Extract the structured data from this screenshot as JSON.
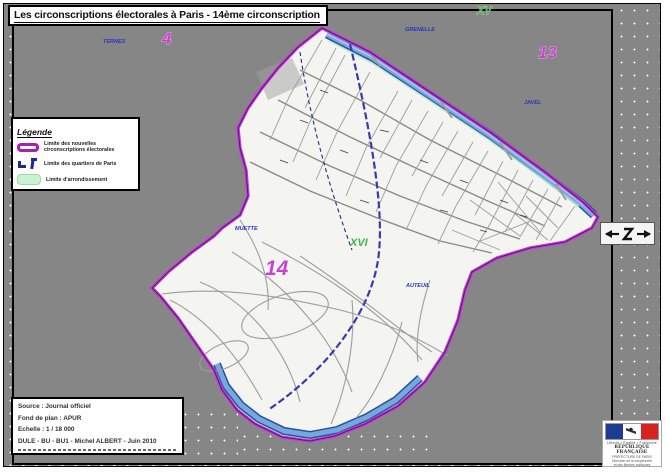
{
  "title": "Les circonscriptions électorales à Paris - 14ème circonscription",
  "legend": {
    "title": "Légende",
    "items": [
      {
        "label": "Limite des nouvelles circonscriptions électorales",
        "color": "#a81fb4",
        "icon": "thick-magenta-line"
      },
      {
        "label": "Limite des quartiers de Paris",
        "color": "#1d2a8f",
        "icon": "blue-corner-marks"
      },
      {
        "label": "Limite d'arrondissement",
        "color": "#c9f2d2",
        "icon": "pale-green-line"
      }
    ]
  },
  "info_box": {
    "lines": [
      "Source : Journal officiel",
      "Fond de plan : APUR",
      "Echelle : 1 / 18 000",
      "DULE - BU - BU1 - Michel ALBERT - Juin 2010"
    ]
  },
  "map": {
    "labels": {
      "circo_here": "14",
      "circo_4": "4",
      "circo_13": "13",
      "arr_15": "XV",
      "arr_16": "XVI",
      "q_ternes": "TERNES",
      "q_grenelle": "GRENELLE",
      "q_javel": "JAVEL",
      "q_muette": "MUETTE",
      "q_auteuil": "AUTEUIL"
    },
    "colors": {
      "circonscription_limit": "#c43fd0",
      "circonscription_core": "#5e1585",
      "river": "#74a9db",
      "river_edge": "#2d4fa0",
      "peripherique": "#3a3aad",
      "arrondissement_limit": "#b9ecc6",
      "background": "#868686",
      "map_fill": "#f4f4f1"
    }
  },
  "logo": {
    "motto": "Liberté • Égalité • Fraternité",
    "republique": "RÉPUBLIQUE FRANÇAISE",
    "lines": [
      "PRÉFECTURE DE PARIS",
      "Direction de la citoyenneté",
      "et des libertés publiques"
    ]
  }
}
